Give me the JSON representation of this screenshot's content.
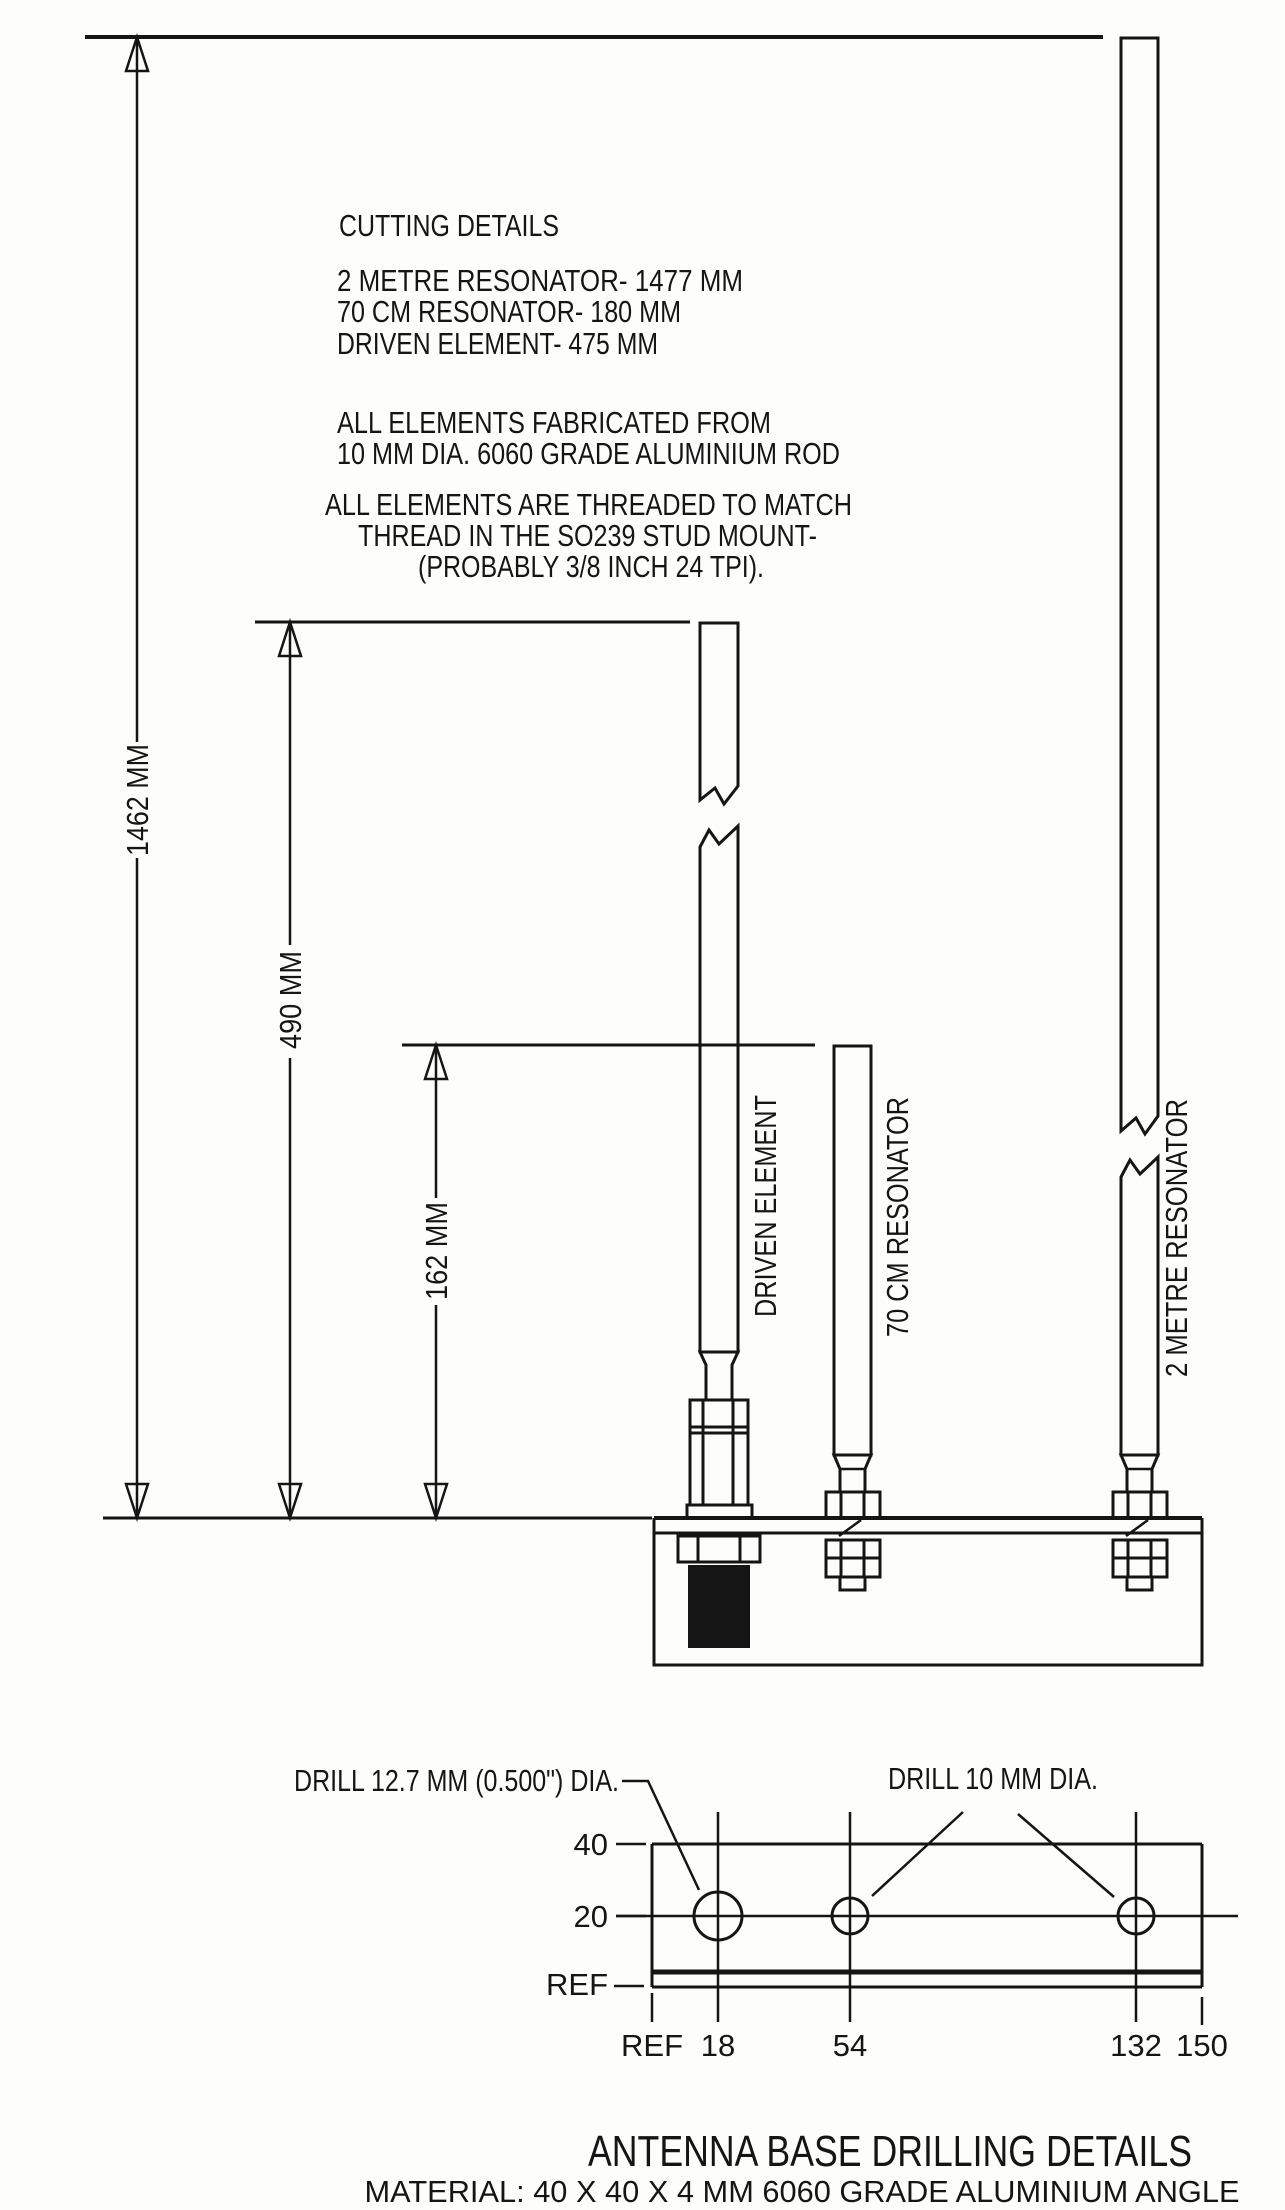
{
  "cutting_notes": {
    "title": "CUTTING DETAILS",
    "lines": [
      "2 METRE RESONATOR-  1477 MM",
      "70 CM RESONATOR- 180 MM",
      "DRIVEN ELEMENT- 475 MM",
      "ALL ELEMENTS FABRICATED FROM",
      "10 MM DIA. 6060 GRADE ALUMINIUM ROD",
      "ALL ELEMENTS ARE THREADED TO MATCH",
      "THREAD IN THE SO239 STUD MOUNT-",
      "(PROBABLY 3/8 INCH 24 TPI)."
    ]
  },
  "dimensions": {
    "overall_height": "1462 MM",
    "driven_height": "490 MM",
    "res70_height": "162 MM"
  },
  "elements": {
    "driven": "DRIVEN ELEMENT",
    "res70": "70 CM RESONATOR",
    "res2m": "2 METRE RESONATOR"
  },
  "drilling": {
    "callout_large_hole": "DRILL 12.7 MM (0.500\") DIA.",
    "callout_small_holes": "DRILL 10 MM DIA.",
    "row_labels": {
      "top": "40",
      "mid": "20",
      "ref": "REF"
    },
    "col_labels": [
      "REF",
      "18",
      "54",
      "132",
      "150"
    ],
    "title": "ANTENNA BASE DRILLING DETAILS",
    "material": "MATERIAL: 40 X 40 X 4 MM 6060 GRADE ALUMINIUM ANGLE"
  },
  "colors": {
    "ink": "#151515",
    "paper": "#fdfdfc"
  }
}
